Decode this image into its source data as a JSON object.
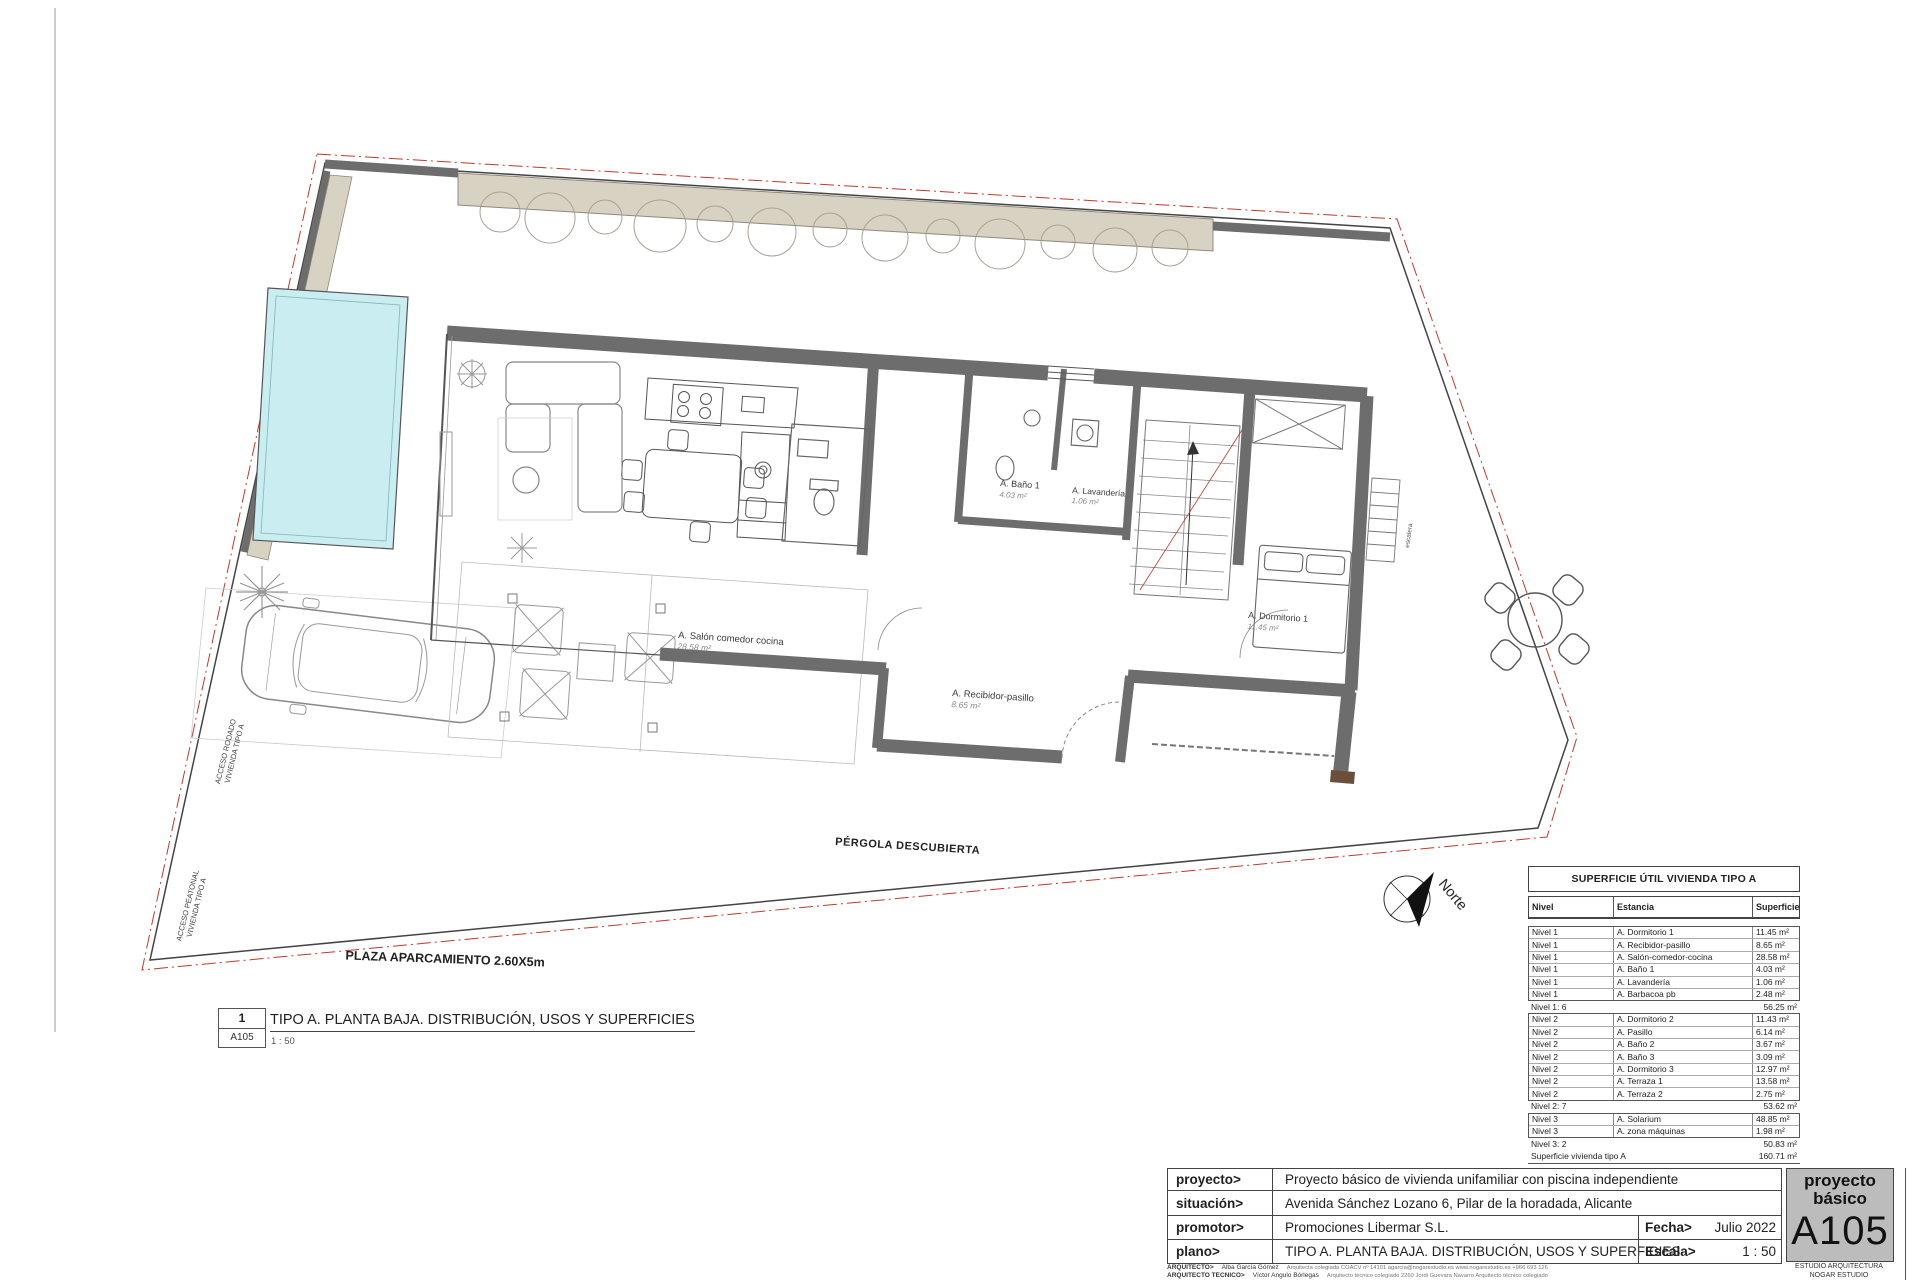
{
  "plan": {
    "north_label": "Norte",
    "rooms": {
      "salon": {
        "label": "A. Salón comedor cocina",
        "area": "28.58 m²"
      },
      "bano1": {
        "label": "A. Baño 1",
        "area": "4.03 m²"
      },
      "lavanderia": {
        "label": "A. Lavandería",
        "area": "1.06 m²"
      },
      "recibidor": {
        "label": "A. Recibidor-pasillo",
        "area": "8.65 m²"
      },
      "dormitorio1": {
        "label": "A. Dormitorio 1",
        "area": "11.45 m²"
      }
    },
    "annotations": {
      "pergola": "PÉRGOLA DESCUBIERTA",
      "plaza_aparcamiento": "PLAZA APARCAMIENTO 2.60X5m",
      "acceso_rodado_line1": "ACCESO RODADO",
      "acceso_rodado_line2": "VIVIENDA TIPO A",
      "acceso_peatonal_line1": "ACCESO PEATONAL",
      "acceso_peatonal_line2": "VIVIENDA TIPO A",
      "escalera": "escalera"
    },
    "colors": {
      "wall_gray": "#6d6d6d",
      "pool_cyan": "#c9edf0",
      "hedge_beige": "#d8d2c3",
      "boundary_red": "#c03a2b",
      "stamp_gray": "#bcbcbc"
    }
  },
  "drawing_title": {
    "number": "1",
    "sheet_ref": "A105",
    "title": "TIPO A. PLANTA BAJA. DISTRIBUCIÓN, USOS Y SUPERFICIES",
    "scale": "1 : 50"
  },
  "area_table": {
    "title": "SUPERFICIE ÚTIL VIVIENDA TIPO A",
    "columns": {
      "nivel": "Nivel",
      "estancia": "Estancia",
      "superficie": "Superficie útil"
    },
    "rows": [
      {
        "nivel": "Nivel 1",
        "estancia": "A. Dormitorio 1",
        "superficie": "11.45 m²"
      },
      {
        "nivel": "Nivel 1",
        "estancia": "A. Recibidor-pasillo",
        "superficie": "8.65 m²"
      },
      {
        "nivel": "Nivel 1",
        "estancia": "A. Salón-comedor-cocina",
        "superficie": "28.58 m²"
      },
      {
        "nivel": "Nivel 1",
        "estancia": "A. Baño 1",
        "superficie": "4.03 m²"
      },
      {
        "nivel": "Nivel 1",
        "estancia": "A. Lavandería",
        "superficie": "1.06 m²"
      },
      {
        "nivel": "Nivel 1",
        "estancia": "A. Barbacoa pb",
        "superficie": "2.48 m²"
      },
      {
        "nivel": "Nivel 1: 6",
        "estancia": "",
        "superficie": "56.25 m²"
      },
      {
        "nivel": "Nivel 2",
        "estancia": "A. Dormitorio 2",
        "superficie": "11.43 m²"
      },
      {
        "nivel": "Nivel 2",
        "estancia": "A. Pasillo",
        "superficie": "6.14 m²"
      },
      {
        "nivel": "Nivel 2",
        "estancia": "A. Baño 2",
        "superficie": "3.67 m²"
      },
      {
        "nivel": "Nivel 2",
        "estancia": "A. Baño 3",
        "superficie": "3.09 m²"
      },
      {
        "nivel": "Nivel 2",
        "estancia": "A. Dormitorio 3",
        "superficie": "12.97 m²"
      },
      {
        "nivel": "Nivel 2",
        "estancia": "A. Terraza 1",
        "superficie": "13.58 m²"
      },
      {
        "nivel": "Nivel 2",
        "estancia": "A. Terraza 2",
        "superficie": "2.75 m²"
      },
      {
        "nivel": "Nivel 2: 7",
        "estancia": "",
        "superficie": "53.62 m²"
      },
      {
        "nivel": "Nivel 3",
        "estancia": "A. Solarium",
        "superficie": "48.85 m²"
      },
      {
        "nivel": "Nivel 3",
        "estancia": "A. zona máquinas",
        "superficie": "1.98 m²"
      },
      {
        "nivel": "Nivel 3: 2",
        "estancia": "",
        "superficie": "50.83 m²"
      },
      {
        "nivel": "Superficie vivienda tipo A",
        "estancia": "",
        "superficie": "160.71 m²"
      }
    ]
  },
  "title_block": {
    "proyecto_label": "proyecto>",
    "proyecto": "Proyecto básico de vivienda unifamiliar con piscina independiente",
    "situacion_label": "situación>",
    "situacion": "Avenida Sánchez Lozano 6, Pilar de la horadada, Alicante",
    "promotor_label": "promotor>",
    "promotor": "Promociones Libermar S.L.",
    "plano_label": "plano>",
    "plano": "TIPO A. PLANTA BAJA. DISTRIBUCIÓN, USOS Y SUPERFICIES",
    "fecha_label": "Fecha>",
    "fecha": "Julio 2022",
    "escala_label": "Escala>",
    "escala": "1 : 50",
    "arquitecto_label": "ARQUITECTO>",
    "arquitecto": "Alba García Gómez",
    "arquitecto_info": "Arquitecta colegiada COACV nº 14101    agarcia@nogarestudio.es    www.nogarestudio.es    +966 693 126",
    "arquitecto_tecnico_label": "ARQUITECTO TÉCNICO>",
    "arquitecto_tecnico": "Víctor Angulo Bórlegas",
    "arquitecto_tecnico_info": "Arquitecto técnico colegiado 2260    Jordi Guevara Navarro    Arquitecto técnico colegiado"
  },
  "stamp": {
    "line1": "proyecto",
    "line2": "básico",
    "code": "A105",
    "studio_line1": "ESTUDIO ARQUITECTURA",
    "studio_line2": "NOGAR ESTUDIO"
  }
}
